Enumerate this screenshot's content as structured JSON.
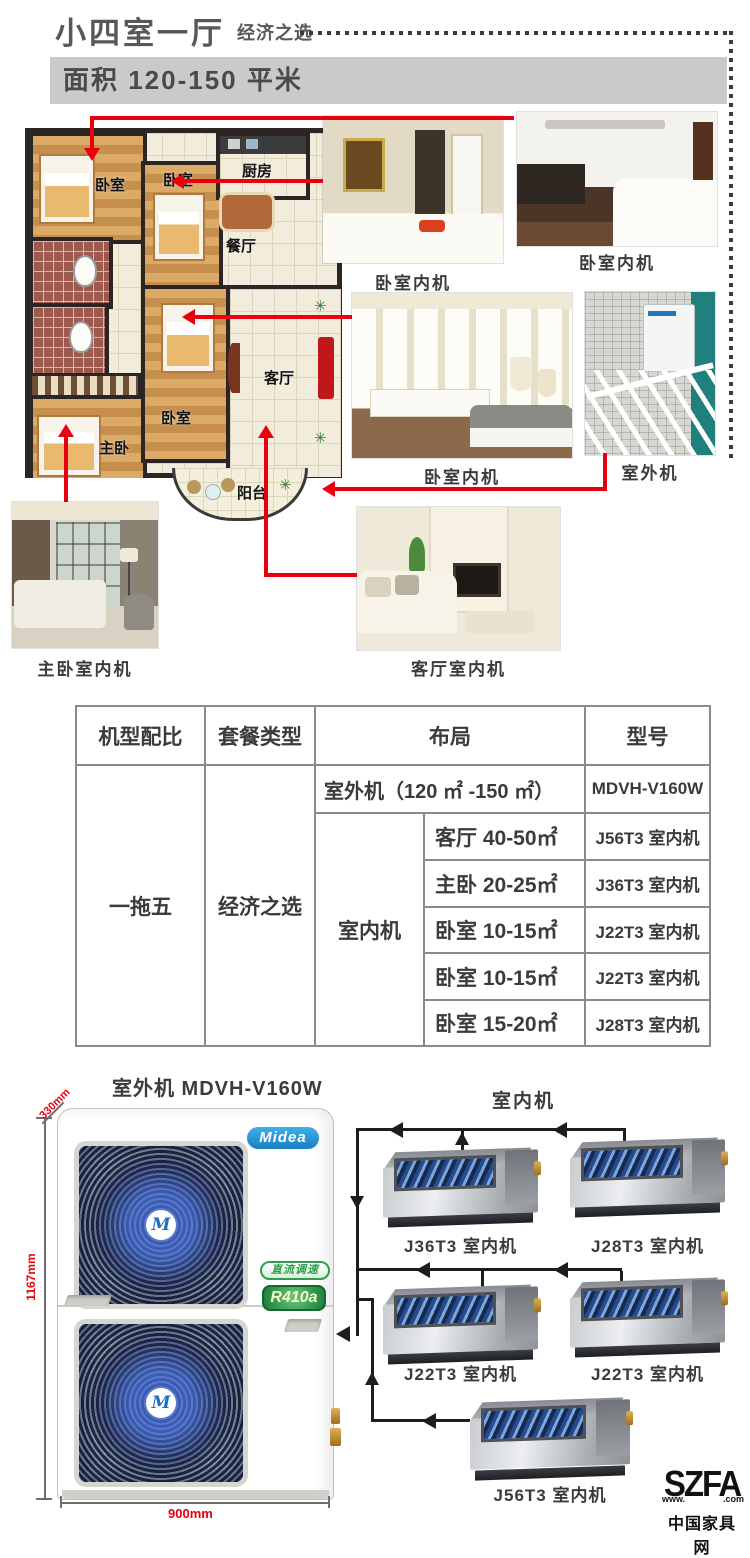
{
  "header": {
    "title": "小四室一厅",
    "subtitle": "经济之选",
    "area": "面积 120-150 平米"
  },
  "floorplan": {
    "bedroom1": "卧室",
    "bedroom2": "卧室",
    "kitchen": "厨房",
    "dining": "餐厅",
    "master": "主卧",
    "bedroom3": "卧室",
    "living": "客厅",
    "balcony": "阳台"
  },
  "photos": {
    "p1": "卧室内机",
    "p2": "卧室内机",
    "p3": "卧室内机",
    "p4": "室外机",
    "p5": "主卧室内机",
    "p6": "客厅室内机"
  },
  "table": {
    "headers": [
      "机型配比",
      "套餐类型",
      "布局",
      "型号"
    ],
    "model_ratio": "一拖五",
    "package_type": "经济之选",
    "outdoor_layout": "室外机（120 ㎡ -150 ㎡）",
    "outdoor_model": "MDVH-V160W",
    "indoor_label": "室内机",
    "rows": [
      {
        "room": "客厅 40-50㎡",
        "model": "J56T3 室内机"
      },
      {
        "room": "主卧 20-25㎡",
        "model": "J36T3 室内机"
      },
      {
        "room": "卧室 10-15㎡",
        "model": "J22T3 室内机"
      },
      {
        "room": "卧室 10-15㎡",
        "model": "J22T3 室内机"
      },
      {
        "room": "卧室 15-20㎡",
        "model": "J28T3 室内机"
      }
    ]
  },
  "product": {
    "outdoor_title": "室外机 MDVH-V160W",
    "indoor_title": "室内机",
    "brand": "Midea",
    "brand_mark": "M",
    "dc_badge": "直流调速",
    "refrigerant": "R410a",
    "dims": {
      "depth": "330mm",
      "height": "1167mm",
      "width": "900mm"
    },
    "units": [
      "J36T3 室内机",
      "J28T3 室内机",
      "J22T3 室内机",
      "J22T3 室内机",
      "J56T3 室内机"
    ]
  },
  "footer": {
    "logo": "SZFA",
    "www": "www.",
    "com": ".com",
    "site": "中国家具网"
  }
}
